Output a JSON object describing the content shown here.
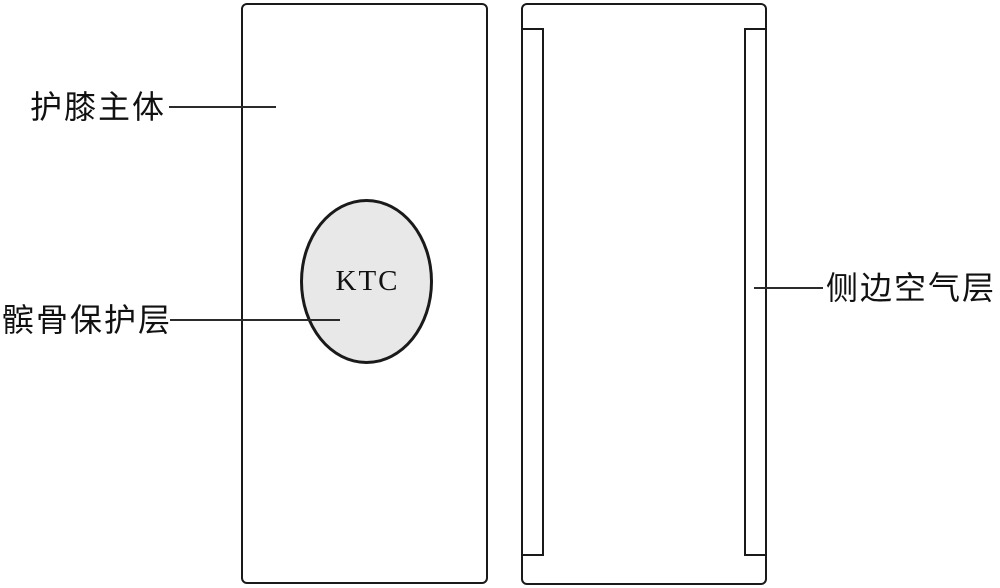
{
  "labels": {
    "kneepad_body": "护膝主体",
    "patella_layer": "髌骨保护层",
    "side_air_layer": "侧边空气层",
    "ktc": "KTC"
  },
  "colors": {
    "background": "#ffffff",
    "outline": "#1a1a1a",
    "line": "#2b2b2b",
    "text": "#111111",
    "ellipse_fill": "#e8e8e8"
  }
}
